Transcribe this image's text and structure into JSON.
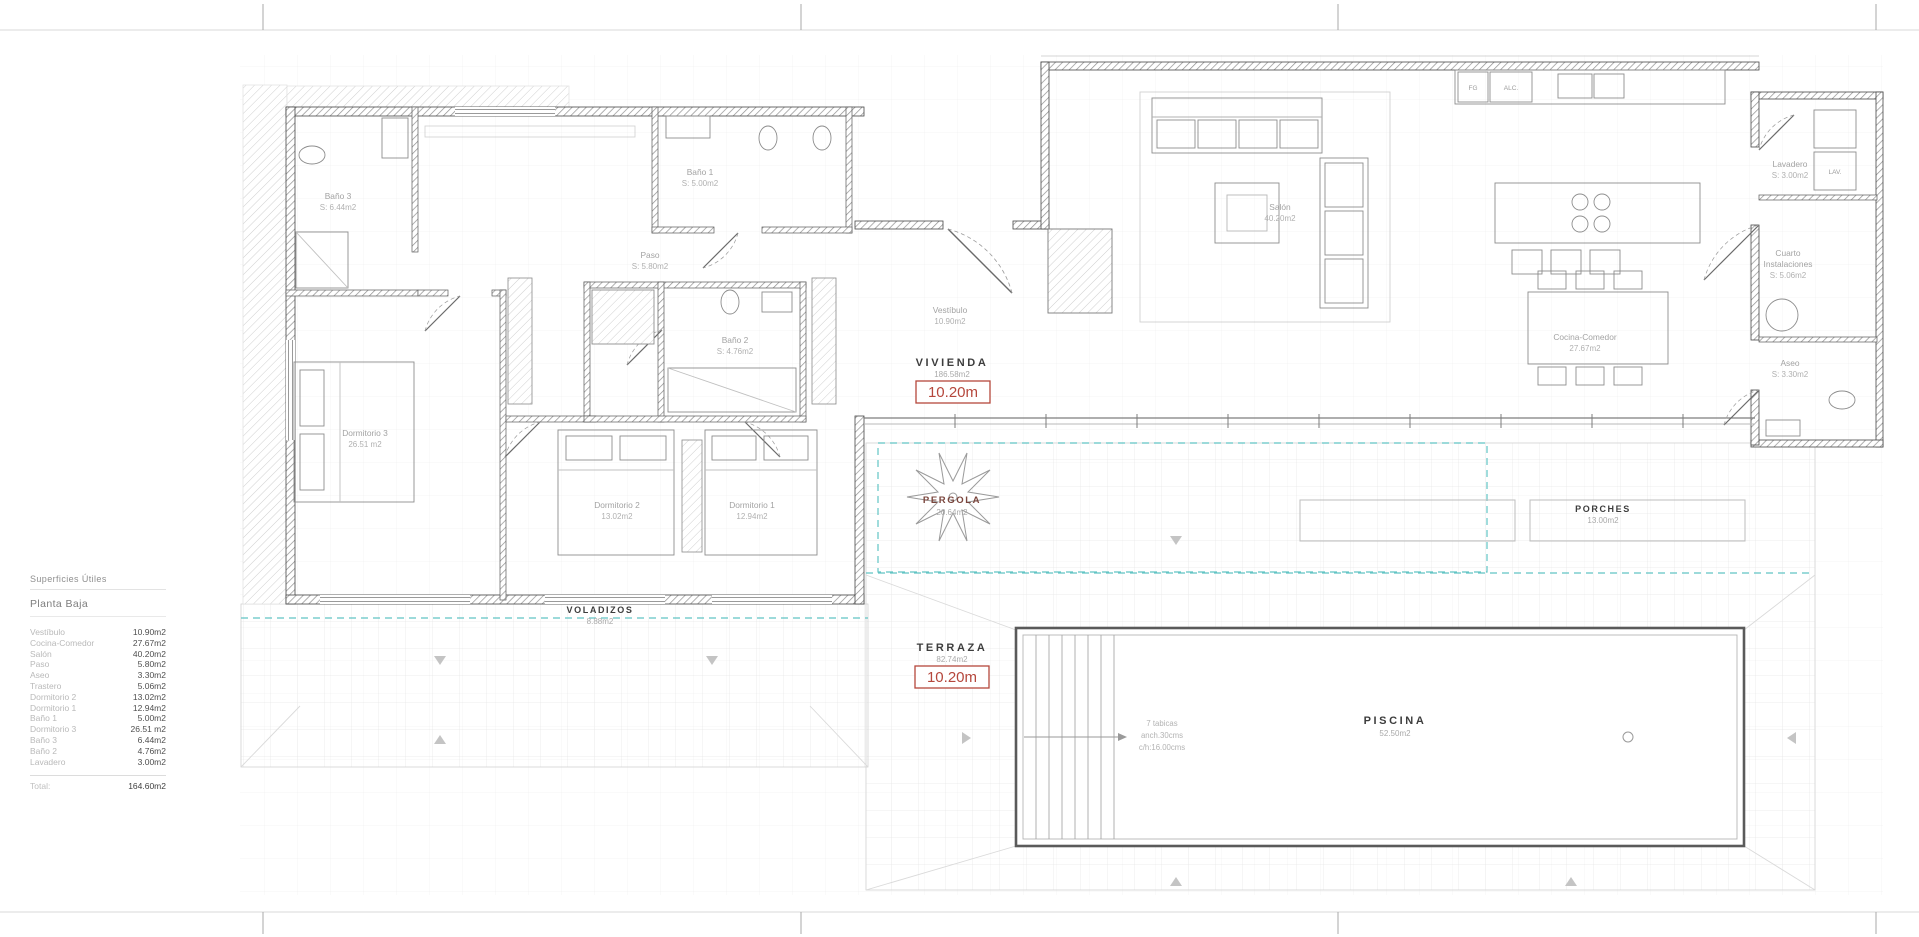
{
  "legend": {
    "title": "Superficies Útiles",
    "subtitle": "Planta Baja",
    "rows": [
      {
        "name": "Vestíbulo",
        "area": "10.90m2"
      },
      {
        "name": "Cocina-Comedor",
        "area": "27.67m2"
      },
      {
        "name": "Salón",
        "area": "40.20m2"
      },
      {
        "name": "Paso",
        "area": "5.80m2"
      },
      {
        "name": "Aseo",
        "area": "3.30m2"
      },
      {
        "name": "Trastero",
        "area": "5.06m2"
      },
      {
        "name": "Dormitorio 2",
        "area": "13.02m2"
      },
      {
        "name": "Dormitorio 1",
        "area": "12.94m2"
      },
      {
        "name": "Baño 1",
        "area": "5.00m2"
      },
      {
        "name": "Dormitorio 3",
        "area": "26.51 m2"
      },
      {
        "name": "Baño 3",
        "area": "6.44m2"
      },
      {
        "name": "Baño 2",
        "area": "4.76m2"
      },
      {
        "name": "Lavadero",
        "area": "3.00m2"
      }
    ],
    "total_label": "Total:",
    "total_value": "164.60m2"
  },
  "zones": {
    "vivienda": {
      "title": "VIVIENDA",
      "area": "186.58m2",
      "dim": "10.20m"
    },
    "terraza": {
      "title": "TERRAZA",
      "area": "82.74m2",
      "dim": "10.20m"
    },
    "piscina": {
      "title": "PISCINA",
      "area": "52.50m2"
    },
    "pergola": {
      "title": "PERGOLA",
      "area": "20.64m2"
    },
    "porches": {
      "title": "PORCHES",
      "area": "13.00m2"
    },
    "voladizos": {
      "title": "VOLADIZOS",
      "area": "8.88m2"
    }
  },
  "rooms": {
    "salon": {
      "name": "Salón",
      "area": "40.20m2"
    },
    "cocina": {
      "name": "Cocina-Comedor",
      "area": "27.67m2"
    },
    "vestibulo": {
      "name": "Vestíbulo",
      "area": "10.90m2"
    },
    "paso": {
      "name": "Paso",
      "area": "S: 5.80m2"
    },
    "bano1": {
      "name": "Baño 1",
      "area": "S: 5.00m2"
    },
    "bano2": {
      "name": "Baño 2",
      "area": "S: 4.76m2"
    },
    "bano3": {
      "name": "Baño 3",
      "area": "S: 6.44m2"
    },
    "dorm1": {
      "name": "Dormitorio 1",
      "area": "12.94m2"
    },
    "dorm2": {
      "name": "Dormitorio 2",
      "area": "13.02m2"
    },
    "dorm3": {
      "name": "Dormitorio 3",
      "area": "26.51 m2"
    },
    "lavadero": {
      "name": "Lavadero",
      "area": "S: 3.00m2"
    },
    "cuarto": {
      "line1": "Cuarto",
      "line2": "Instalaciones",
      "area": "S: 5.06m2"
    },
    "aseo": {
      "name": "Aseo",
      "area": "S: 3.30m2"
    }
  },
  "annotations": {
    "pool_steps": {
      "l1": "7 tabicas",
      "l2": "anch.30cms",
      "l3": "c/h:16.00cms"
    }
  },
  "tags": {
    "lav": "LAV.",
    "fg": "FG",
    "alc": "ALC."
  },
  "colors": {
    "accent_red": "#b5473c",
    "teal": "#62c4c4",
    "wall": "#3f3f3f"
  }
}
